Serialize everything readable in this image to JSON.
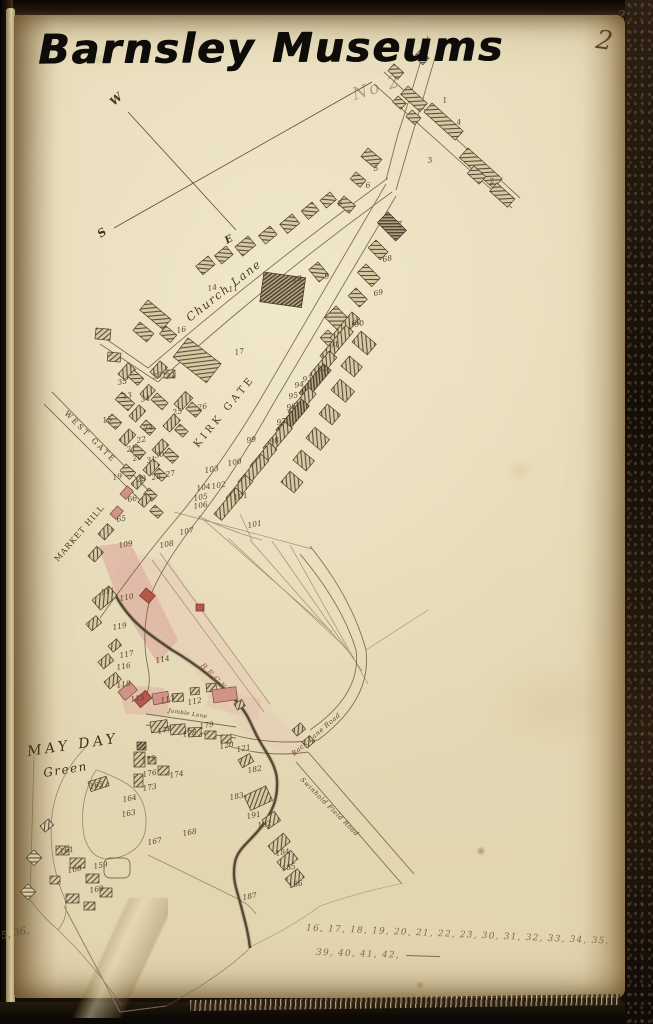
{
  "page": {
    "watermark": "Barnsley Museums",
    "page_number": "2",
    "corner_mark": "2",
    "pencil_note": "No 2",
    "margin_note": "5, 36,",
    "footnote_line1": "16, 17, 18, 19, 20, 21, 22, 23, 30, 31, 32, 33, 34, 35,",
    "footnote_line2": "39, 40, 41, 42,"
  },
  "colors": {
    "paper": "#e6dab8",
    "ink": "#6d5b42",
    "label_ink": "#4c3a26",
    "beck_ink": "#96603e",
    "pink_wash": "#e8c9b6",
    "red_building": "#b5574a",
    "cover": "#1f1610"
  },
  "map": {
    "compass_letters": [
      {
        "t": "W",
        "x": 114,
        "y": 106,
        "r": -42,
        "s": 11
      },
      {
        "t": "S",
        "x": 101,
        "y": 238,
        "r": -38,
        "s": 11
      },
      {
        "t": "E",
        "x": 227,
        "y": 244,
        "r": -30,
        "s": 10
      }
    ],
    "street_labels": [
      {
        "text": "Church Lane",
        "path": "p-churchlane",
        "size": 11.5,
        "ls": 1.5,
        "color": "#4c3a26",
        "italic": true
      },
      {
        "text": "KIRK GATE",
        "path": "p-kirkgate",
        "size": 10,
        "ls": 3.5,
        "color": "#4c3a26",
        "italic": false
      },
      {
        "text": "WEST GATE",
        "path": "p-westgate",
        "size": 7.5,
        "ls": 2.5,
        "color": "#4c3a26",
        "italic": false
      },
      {
        "text": "MARKET HILL",
        "path": "p-markethill",
        "size": 8,
        "ls": 1,
        "color": "#4c3a26",
        "italic": false
      },
      {
        "text": "BECK",
        "path": "p-beck",
        "size": 8,
        "ls": 3,
        "color": "#96603e",
        "italic": true
      },
      {
        "text": "Jumble Lane",
        "path": "p-jumble",
        "size": 5.5,
        "ls": 0.4,
        "color": "#55432c",
        "italic": true
      },
      {
        "text": "Back Lane Road",
        "path": "p-backlane",
        "size": 6.5,
        "ls": 0.6,
        "color": "#55432c",
        "italic": true
      },
      {
        "text": "Swinhold Field Road",
        "path": "p-swinhold",
        "size": 6.5,
        "ls": 0.6,
        "color": "#55432c",
        "italic": true
      },
      {
        "text": "MAY DAY",
        "path": "p-mayday",
        "size": 14,
        "ls": 3.5,
        "color": "#42331f",
        "italic": true
      },
      {
        "text": "Green",
        "path": "p-green",
        "size": 12,
        "ls": 1.5,
        "color": "#42331f",
        "italic": true
      }
    ],
    "plot_numbers": [
      [
        1,
        443,
        103
      ],
      [
        4,
        457,
        125
      ],
      [
        3,
        428,
        163
      ],
      [
        2,
        490,
        184
      ],
      [
        5,
        374,
        171
      ],
      [
        6,
        366,
        188
      ],
      [
        8,
        338,
        206
      ],
      [
        7,
        398,
        227
      ],
      [
        68,
        383,
        262
      ],
      [
        69,
        374,
        296
      ],
      [
        60,
        352,
        326
      ],
      [
        9,
        325,
        279
      ],
      [
        10,
        293,
        282
      ],
      [
        11,
        229,
        292
      ],
      [
        14,
        208,
        291
      ],
      [
        16,
        177,
        333
      ],
      [
        17,
        235,
        355
      ],
      [
        90,
        355,
        327
      ],
      [
        91,
        330,
        348
      ],
      [
        92,
        318,
        372
      ],
      [
        93,
        303,
        382
      ],
      [
        94,
        295,
        388
      ],
      [
        95,
        289,
        399
      ],
      [
        96,
        287,
        410
      ],
      [
        97,
        277,
        425
      ],
      [
        98,
        270,
        444
      ],
      [
        99,
        247,
        443
      ],
      [
        100,
        228,
        466
      ],
      [
        103,
        205,
        473
      ],
      [
        102,
        212,
        489
      ],
      [
        104,
        197,
        491
      ],
      [
        105,
        194,
        501
      ],
      [
        106,
        194,
        509
      ],
      [
        101,
        234,
        500
      ],
      [
        101,
        248,
        528
      ],
      [
        107,
        180,
        535
      ],
      [
        108,
        160,
        548
      ],
      [
        35,
        118,
        385
      ],
      [
        33,
        153,
        379
      ],
      [
        32,
        166,
        379
      ],
      [
        13,
        123,
        399
      ],
      [
        34,
        141,
        402
      ],
      [
        15,
        103,
        423
      ],
      [
        25,
        173,
        415
      ],
      [
        26,
        198,
        410
      ],
      [
        24,
        144,
        431
      ],
      [
        22,
        137,
        443
      ],
      [
        21,
        127,
        452
      ],
      [
        20,
        133,
        461
      ],
      [
        31,
        147,
        463
      ],
      [
        30,
        155,
        458
      ],
      [
        19,
        113,
        480
      ],
      [
        29,
        137,
        482
      ],
      [
        28,
        152,
        480
      ],
      [
        27,
        166,
        477
      ],
      [
        66,
        128,
        502
      ],
      [
        65,
        117,
        522
      ],
      [
        109,
        119,
        548
      ],
      [
        111,
        101,
        595
      ],
      [
        110,
        120,
        601
      ],
      [
        119,
        113,
        630
      ],
      [
        117,
        120,
        658
      ],
      [
        116,
        117,
        670
      ],
      [
        118,
        117,
        688
      ],
      [
        115,
        131,
        702
      ],
      [
        113,
        161,
        703
      ],
      [
        112,
        188,
        705
      ],
      [
        114,
        156,
        663
      ],
      [
        120,
        220,
        749
      ],
      [
        121,
        237,
        752
      ],
      [
        182,
        248,
        773
      ],
      [
        183,
        230,
        800
      ],
      [
        177,
        158,
        734
      ],
      [
        178,
        183,
        737
      ],
      [
        179,
        200,
        729
      ],
      [
        175,
        142,
        763
      ],
      [
        176,
        143,
        777
      ],
      [
        173,
        143,
        791
      ],
      [
        174,
        170,
        778
      ],
      [
        165,
        90,
        789
      ],
      [
        164,
        123,
        802
      ],
      [
        163,
        122,
        817
      ],
      [
        161,
        60,
        854
      ],
      [
        160,
        68,
        873
      ],
      [
        159,
        94,
        869
      ],
      [
        169,
        90,
        893
      ],
      [
        167,
        148,
        845
      ],
      [
        168,
        183,
        836
      ],
      [
        191,
        247,
        819
      ],
      [
        192,
        258,
        828
      ],
      [
        184,
        276,
        856
      ],
      [
        185,
        282,
        871
      ],
      [
        186,
        289,
        888
      ],
      [
        187,
        243,
        900
      ]
    ]
  }
}
